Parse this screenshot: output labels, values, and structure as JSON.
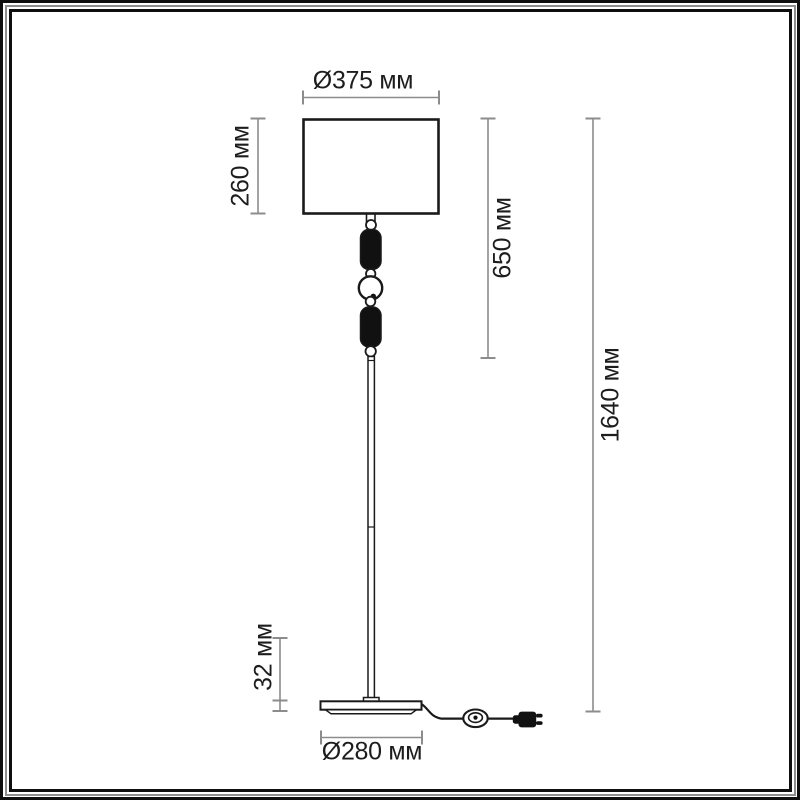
{
  "drawing": {
    "kind": "floor-lamp-dimension-diagram",
    "labels": {
      "shade_diameter": "Ø375 мм",
      "shade_height": "260 мм",
      "upper_section_height": "650 мм",
      "total_height": "1640 мм",
      "base_height": "32 мм",
      "base_diameter": "Ø280 мм"
    },
    "colors": {
      "artwork_line": "#1a1a1a",
      "artwork_fill": "#111111",
      "dimension_line": "#8c8c8c",
      "label_text": "#1d1d1d",
      "background": "#ffffff",
      "frame": "#0e0e0e",
      "frame_accent": "#8e8e8e"
    }
  }
}
